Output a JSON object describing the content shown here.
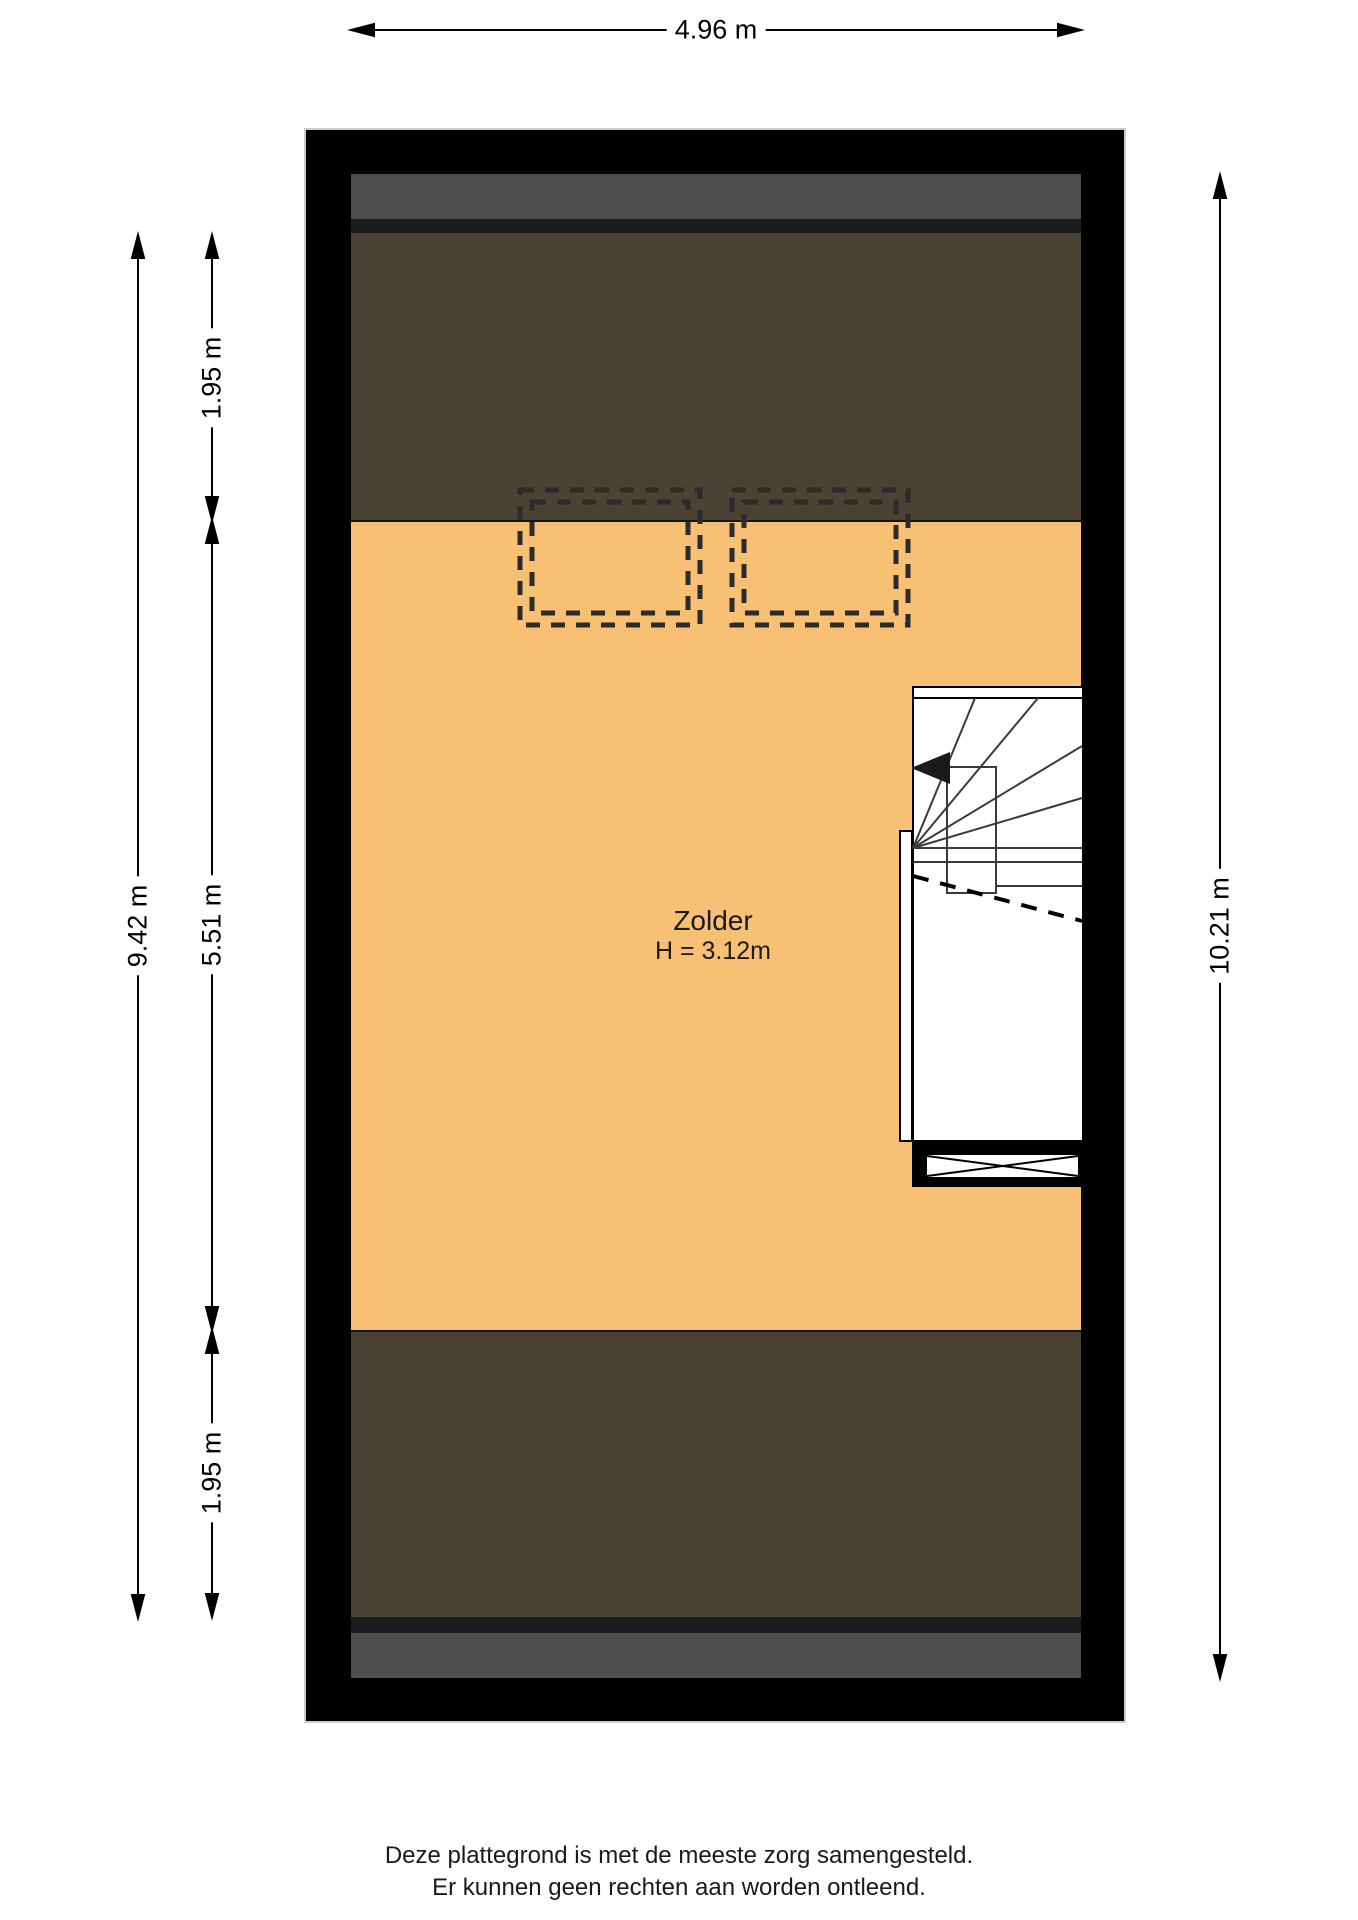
{
  "dimensions": {
    "top_width": "4.96 m",
    "left_total_height": "9.42 m",
    "left_top_segment": "1.95 m",
    "left_middle_segment": "5.51 m",
    "left_bottom_segment": "1.95 m",
    "right_total_height": "10.21 m"
  },
  "room": {
    "name": "Zolder",
    "ceiling_height": "H = 3.12m"
  },
  "footer": {
    "line1": "Deze plattegrond is met de meeste zorg samengesteld.",
    "line2": "Er kunnen geen rechten aan worden ontleend."
  },
  "colors": {
    "wall": "#000000",
    "floor": "#F7C074",
    "roof_slope": "#4A4233",
    "roof_edge_band": "#4E4E50",
    "roof_dark_strip": "#1D1D1E",
    "dormer_outline": "#2B2B2B"
  }
}
